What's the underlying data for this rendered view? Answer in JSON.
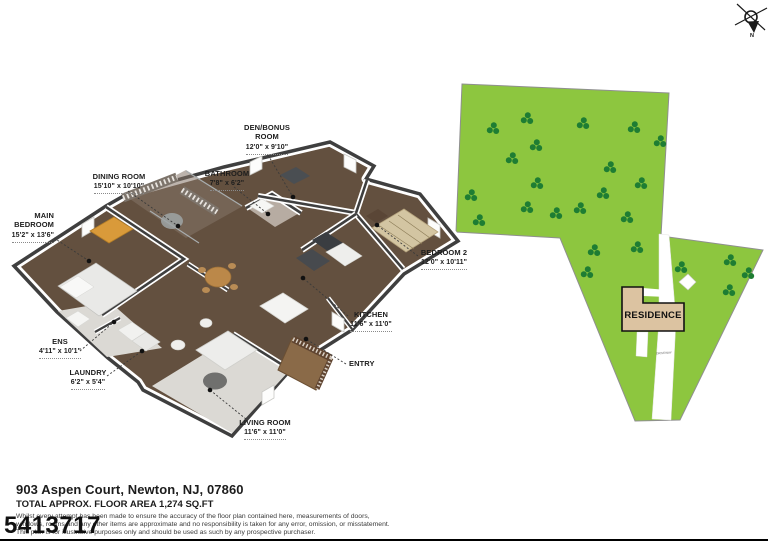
{
  "compass": {
    "north_label": "N"
  },
  "floor_plan": {
    "rooms": [
      {
        "id": "main-bedroom",
        "name": "MAIN BEDROOM",
        "dims": "15'2\" x 13'6\""
      },
      {
        "id": "dining-room",
        "name": "DINING ROOM",
        "dims": "15'10\" x 10'10\""
      },
      {
        "id": "den-bonus-room",
        "name": "DEN/BONUS ROOM",
        "dims": "12'0\" x 9'10\""
      },
      {
        "id": "bathroom",
        "name": "BATHROOM",
        "dims": "7'8\" x 6'2\""
      },
      {
        "id": "bedroom-2",
        "name": "BEDROOM 2",
        "dims": "12'0\" x 10'11\""
      },
      {
        "id": "kitchen",
        "name": "KITCHEN",
        "dims": "11'6\" x 11'0\""
      },
      {
        "id": "ens",
        "name": "ENS",
        "dims": "4'11\" x 10'1\""
      },
      {
        "id": "laundry",
        "name": "LAUNDRY",
        "dims": "6'2\" x 5'4\""
      },
      {
        "id": "entry",
        "name": "ENTRY"
      },
      {
        "id": "living-room",
        "name": "LIVING ROOM",
        "dims": "11'6\" x 11'0\""
      }
    ]
  },
  "site_plan": {
    "residence_label": "RESIDENCE",
    "driveway_label": "DRIVEWAY"
  },
  "footer": {
    "address": "903 Aspen Court, Newton, NJ, 07860",
    "area": "TOTAL APPROX. FLOOR AREA 1,274 SQ.FT",
    "disclaimer_line1": "Whilst every attempt has been made to ensure the accuracy of the floor plan contained here, measurements of doors,",
    "disclaimer_line2": "windows, rooms and any other items are approximate and no responsibility is taken for any error, omission, or misstatement.",
    "disclaimer_line3": "This plan is for illustrative purposes only and should be used as such by any prospective purchaser.",
    "listing_id": "5413717"
  },
  "colors": {
    "lot_green": "#8dc63f",
    "tree_green": "#1e7d33",
    "residence_tan": "#dcc3a1",
    "wood_floor": "#63503f",
    "carpet": "#dbd9d4",
    "wall_top": "#3f3f3f"
  }
}
